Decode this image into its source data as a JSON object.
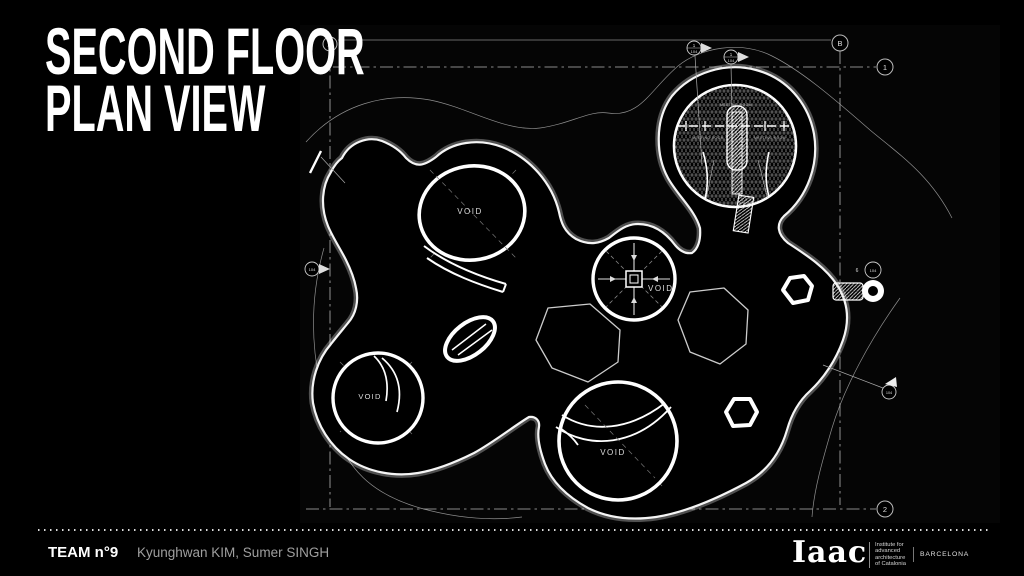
{
  "title": {
    "line1": "SECOND FLOOR",
    "line2": "PLAN VIEW"
  },
  "footer": {
    "team": "TEAM n°9",
    "members": "Kyunghwan KIM, Sumer SINGH"
  },
  "logo": {
    "name": "Iaac",
    "institute_lines": [
      "Institute for",
      "advanced",
      "architecture",
      "of Catalonia"
    ],
    "city": "BARCELONA"
  },
  "drawing": {
    "grid_markers": [
      {
        "label": "A"
      },
      {
        "label": "B"
      },
      {
        "label": "1"
      },
      {
        "label": "2"
      }
    ],
    "voids": [
      {
        "label": "VOID"
      },
      {
        "label": "VOID"
      },
      {
        "label": "VOID"
      },
      {
        "label": "VOID"
      }
    ],
    "rooms": [
      {
        "label": "MEETING ROOM"
      },
      {
        "label": "MEETING ROOM"
      },
      {
        "label": "MEETING ROOM"
      }
    ],
    "section_markers": [
      {
        "num": "1",
        "sheet": "104"
      },
      {
        "num": "1",
        "sheet": "104"
      },
      {
        "sheet": "104"
      },
      {
        "num": "6",
        "sheet": "104"
      },
      {
        "sheet": "104"
      }
    ],
    "colors": {
      "mesh_line": "#e0e0e0",
      "background": "#000000",
      "contour": "#909090",
      "accent": "#ffffff"
    }
  }
}
